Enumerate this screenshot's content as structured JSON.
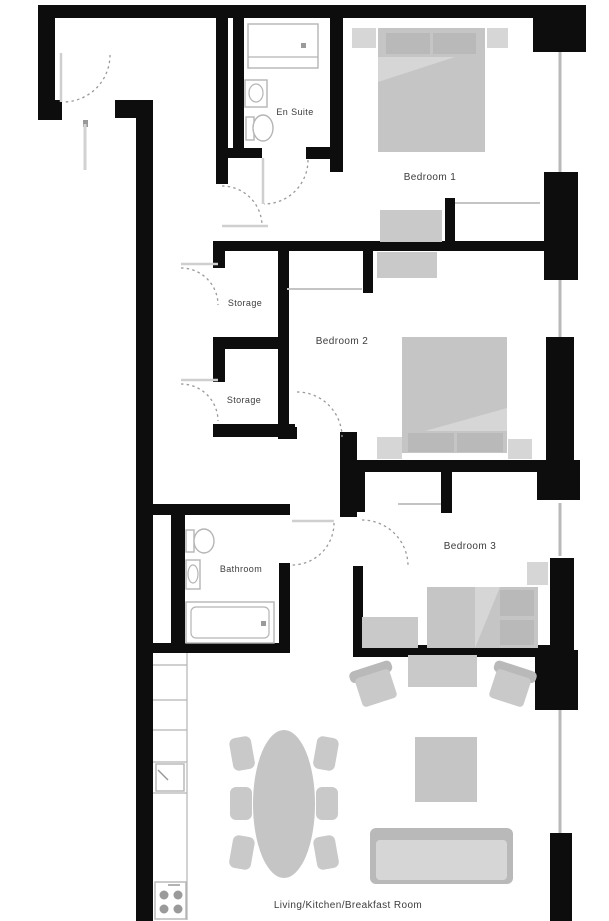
{
  "floorplan": {
    "type": "apartment-floor-plan",
    "rooms": [
      {
        "key": "en-suite",
        "label": "En Suite"
      },
      {
        "key": "bedroom-1",
        "label": "Bedroom 1"
      },
      {
        "key": "storage-1",
        "label": "Storage"
      },
      {
        "key": "bedroom-2",
        "label": "Bedroom 2"
      },
      {
        "key": "storage-2",
        "label": "Storage"
      },
      {
        "key": "bathroom",
        "label": "Bathroom"
      },
      {
        "key": "bedroom-3",
        "label": "Bedroom 3"
      },
      {
        "key": "living",
        "label": "Living/Kitchen/Breakfast Room"
      }
    ],
    "colors": {
      "wall": "#0d0d0d",
      "window": "#b9b9b9",
      "door_arc": "#9a9a9a",
      "furniture": "#c5c5c5",
      "furniture_dark": "#b9b9b9",
      "furniture_light": "#d6d6d6",
      "fixture_outline": "#b5b5b5",
      "label_text": "#3c3c3c",
      "background": "#ffffff"
    }
  }
}
